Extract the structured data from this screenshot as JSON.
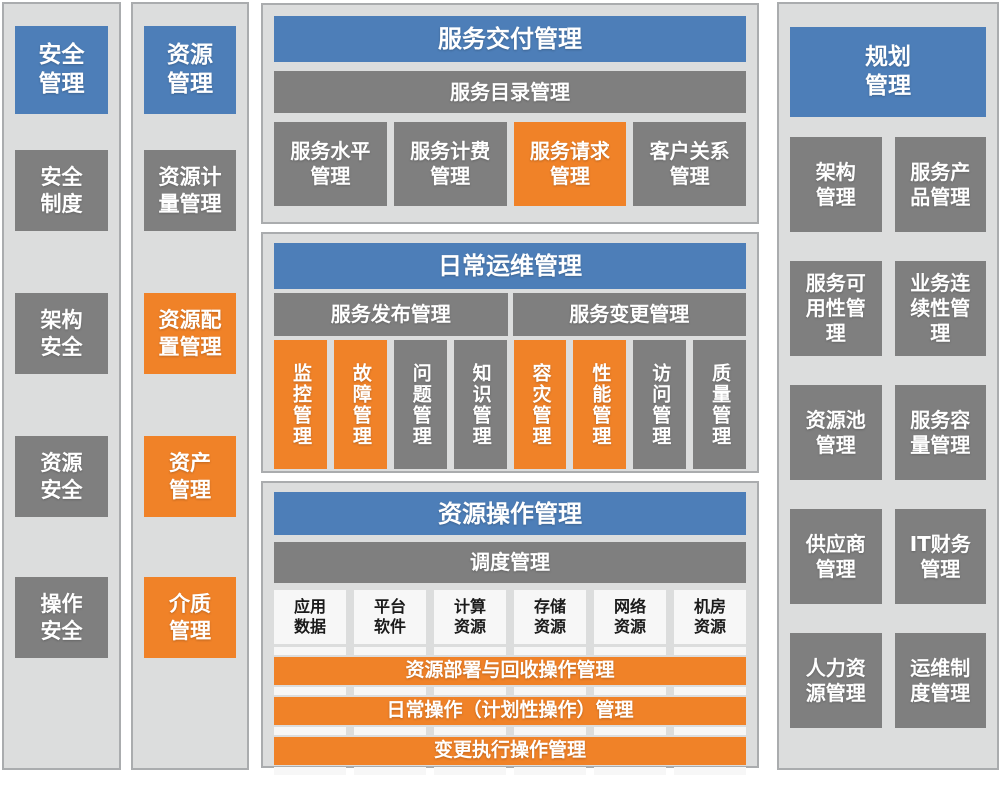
{
  "colors": {
    "blue": "#4d7eb8",
    "gray": "#7f7f7f",
    "orange": "#f08228",
    "panel_bg": "#dcdddd",
    "panel_border": "#aaacae",
    "white_box": "#f7f7f7",
    "dark_text": "#1a1a1a"
  },
  "security": {
    "title": "安全\n管理",
    "items": [
      {
        "label": "安全\n制度"
      },
      {
        "label": "架构\n安全"
      },
      {
        "label": "资源\n安全"
      },
      {
        "label": "操作\n安全"
      }
    ]
  },
  "resource": {
    "title": "资源\n管理",
    "items": [
      {
        "label": "资源计\n量管理",
        "variant": "gray"
      },
      {
        "label": "资源配\n置管理",
        "variant": "orange"
      },
      {
        "label": "资产\n管理",
        "variant": "orange"
      },
      {
        "label": "介质\n管理",
        "variant": "orange"
      }
    ]
  },
  "service_delivery": {
    "title": "服务交付管理",
    "subheader": "服务目录管理",
    "items": [
      {
        "label": "服务水平\n管理",
        "variant": "gray"
      },
      {
        "label": "服务计费\n管理",
        "variant": "gray"
      },
      {
        "label": "服务请求\n管理",
        "variant": "orange"
      },
      {
        "label": "客户关系\n管理",
        "variant": "gray"
      }
    ]
  },
  "daily_ops": {
    "title": "日常运维管理",
    "subheaders": [
      {
        "label": "服务发布管理"
      },
      {
        "label": "服务变更管理"
      }
    ],
    "items": [
      {
        "label": "监控管理",
        "variant": "orange"
      },
      {
        "label": "故障管理",
        "variant": "orange"
      },
      {
        "label": "问题管理",
        "variant": "gray"
      },
      {
        "label": "知识管理",
        "variant": "gray"
      },
      {
        "label": "容灾管理",
        "variant": "orange"
      },
      {
        "label": "性能管理",
        "variant": "orange"
      },
      {
        "label": "访问管理",
        "variant": "gray"
      },
      {
        "label": "质量管理",
        "variant": "gray"
      }
    ]
  },
  "resource_ops": {
    "title": "资源操作管理",
    "subheader": "调度管理",
    "resources": [
      {
        "label": "应用\n数据"
      },
      {
        "label": "平台\n软件"
      },
      {
        "label": "计算\n资源"
      },
      {
        "label": "存储\n资源"
      },
      {
        "label": "网络\n资源"
      },
      {
        "label": "机房\n资源"
      }
    ],
    "bars": [
      {
        "label": "资源部署与回收操作管理"
      },
      {
        "label": "日常操作（计划性操作）管理"
      },
      {
        "label": "变更执行操作管理"
      }
    ]
  },
  "planning": {
    "title": "规划\n管理",
    "items": [
      {
        "label": "架构\n管理"
      },
      {
        "label": "服务产\n品管理"
      },
      {
        "label": "服务可\n用性管\n理"
      },
      {
        "label": "业务连\n续性管\n理"
      },
      {
        "label": "资源池\n管理"
      },
      {
        "label": "服务容\n量管理"
      },
      {
        "label": "供应商\n管理"
      },
      {
        "label": "IT财务\n管理"
      },
      {
        "label": "人力资\n源管理"
      },
      {
        "label": "运维制\n度管理"
      }
    ]
  }
}
